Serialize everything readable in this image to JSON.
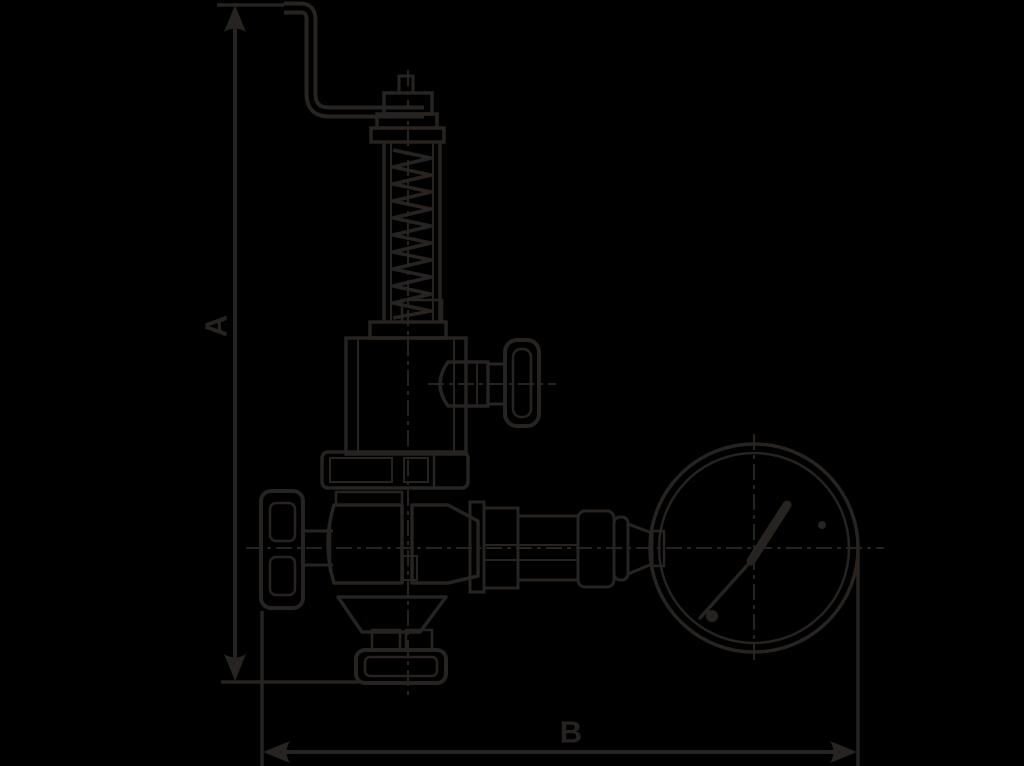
{
  "canvas": {
    "background": "#000000",
    "line_color": "#262321"
  },
  "diagram": {
    "type": "technical-drawing",
    "subject": "spring-loaded relief valve with lever, handwheels and pressure gauge, side elevation",
    "dimension_labels": {
      "a": "A",
      "b": "B"
    }
  }
}
